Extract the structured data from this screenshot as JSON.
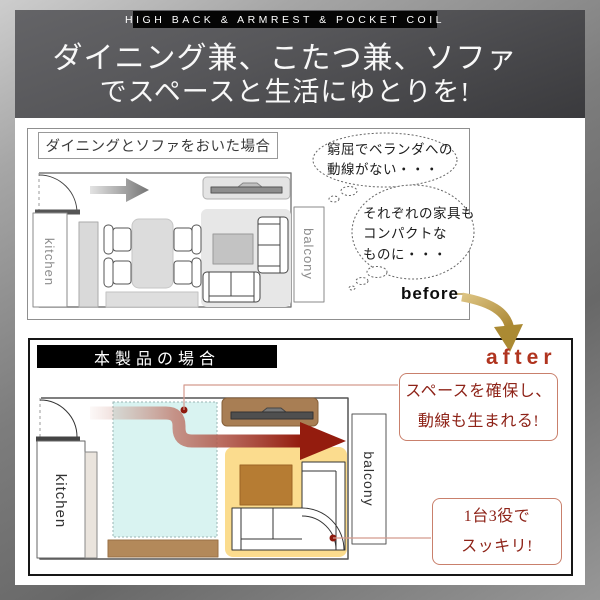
{
  "header": {
    "badge": "HIGH BACK & ARMREST & POCKET COIL",
    "title_line1": "ダイニング兼、こたつ兼、ソファ",
    "title_line2": "でスペースと生活にゆとりを!"
  },
  "before_section": {
    "label": "ダイニングとソファをおいた場合",
    "tag": "before",
    "room_labels": {
      "kitchen": "kitchen",
      "balcony": "balcony"
    },
    "thought_bubbles": [
      {
        "lines": [
          "窮屈でベランダへの",
          "動線がない・・・"
        ]
      },
      {
        "lines": [
          "それぞれの家具も",
          "コンパクトな",
          "ものに・・・"
        ]
      }
    ]
  },
  "after_section": {
    "label": "本製品の場合",
    "tag": "after",
    "room_labels": {
      "kitchen": "kitchen",
      "balcony": "balcony"
    },
    "callouts": [
      {
        "lines": [
          "スペースを確保し、",
          "動線も生まれる!"
        ]
      },
      {
        "lines": [
          "1台3役で",
          "スッキリ!"
        ]
      }
    ]
  },
  "colors": {
    "accent_red": "#941c0e",
    "after_text": "#b0341f",
    "callout_text": "#8e2318",
    "callout_border": "#c9806c",
    "gold_arrow": "#b18c38",
    "highlight_yellow": "#fbdc8e",
    "highlight_cyan": "#d9f3f1",
    "wood_brown": "#a87e54"
  }
}
